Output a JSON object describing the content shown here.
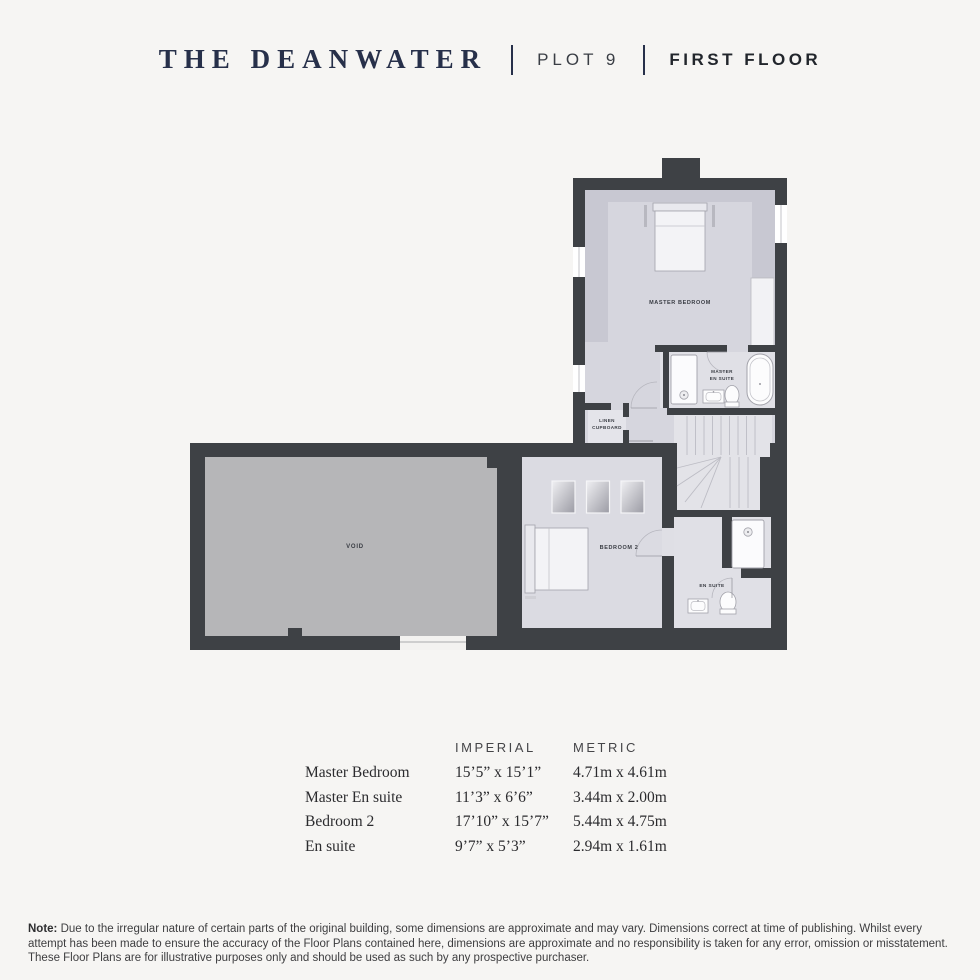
{
  "header": {
    "title": "THE DEANWATER",
    "divider": "|",
    "plot": "PLOT 9",
    "floor": "FIRST FLOOR"
  },
  "floorplan": {
    "rooms": {
      "master_bedroom": "MASTER BEDROOM",
      "master_en_suite_line1": "MASTER",
      "master_en_suite_line2": "EN SUITE",
      "linen_line1": "LINEN",
      "linen_line2": "CUPBOARD",
      "bedroom2": "BEDROOM 2",
      "en_suite": "EN SUITE",
      "void": "VOID"
    },
    "colors": {
      "wall": "#3e4145",
      "floor_light": "#d6d6de",
      "floor_sloped": "#c8c8d2",
      "floor_void": "#b6b6b8",
      "floor_landing": "#e3e3e8",
      "fixture": "#fcfcfd"
    }
  },
  "dimensions_table": {
    "headers": {
      "imperial": "IMPERIAL",
      "metric": "METRIC"
    },
    "rows": [
      {
        "room": "Master Bedroom",
        "imperial": "15’5” x 15’1”",
        "metric": "4.71m x 4.61m"
      },
      {
        "room": "Master En suite",
        "imperial": "11’3” x 6’6”",
        "metric": "3.44m x 2.00m"
      },
      {
        "room": "Bedroom 2",
        "imperial": "17’10” x 15’7”",
        "metric": "5.44m x 4.75m"
      },
      {
        "room": "En suite",
        "imperial": "9’7” x 5’3”",
        "metric": "2.94m x 1.61m"
      }
    ]
  },
  "note": {
    "label": "Note:",
    "text": " Due to the irregular nature of certain parts of the original building, some dimensions are approximate and may vary. Dimensions correct at time of publishing. Whilst every attempt has been made to ensure the accuracy of the Floor Plans contained here, dimensions are approximate and no responsibility is taken for any error, omission or misstatement. These Floor Plans are for illustrative purposes only and should be used as such by any prospective purchaser."
  }
}
